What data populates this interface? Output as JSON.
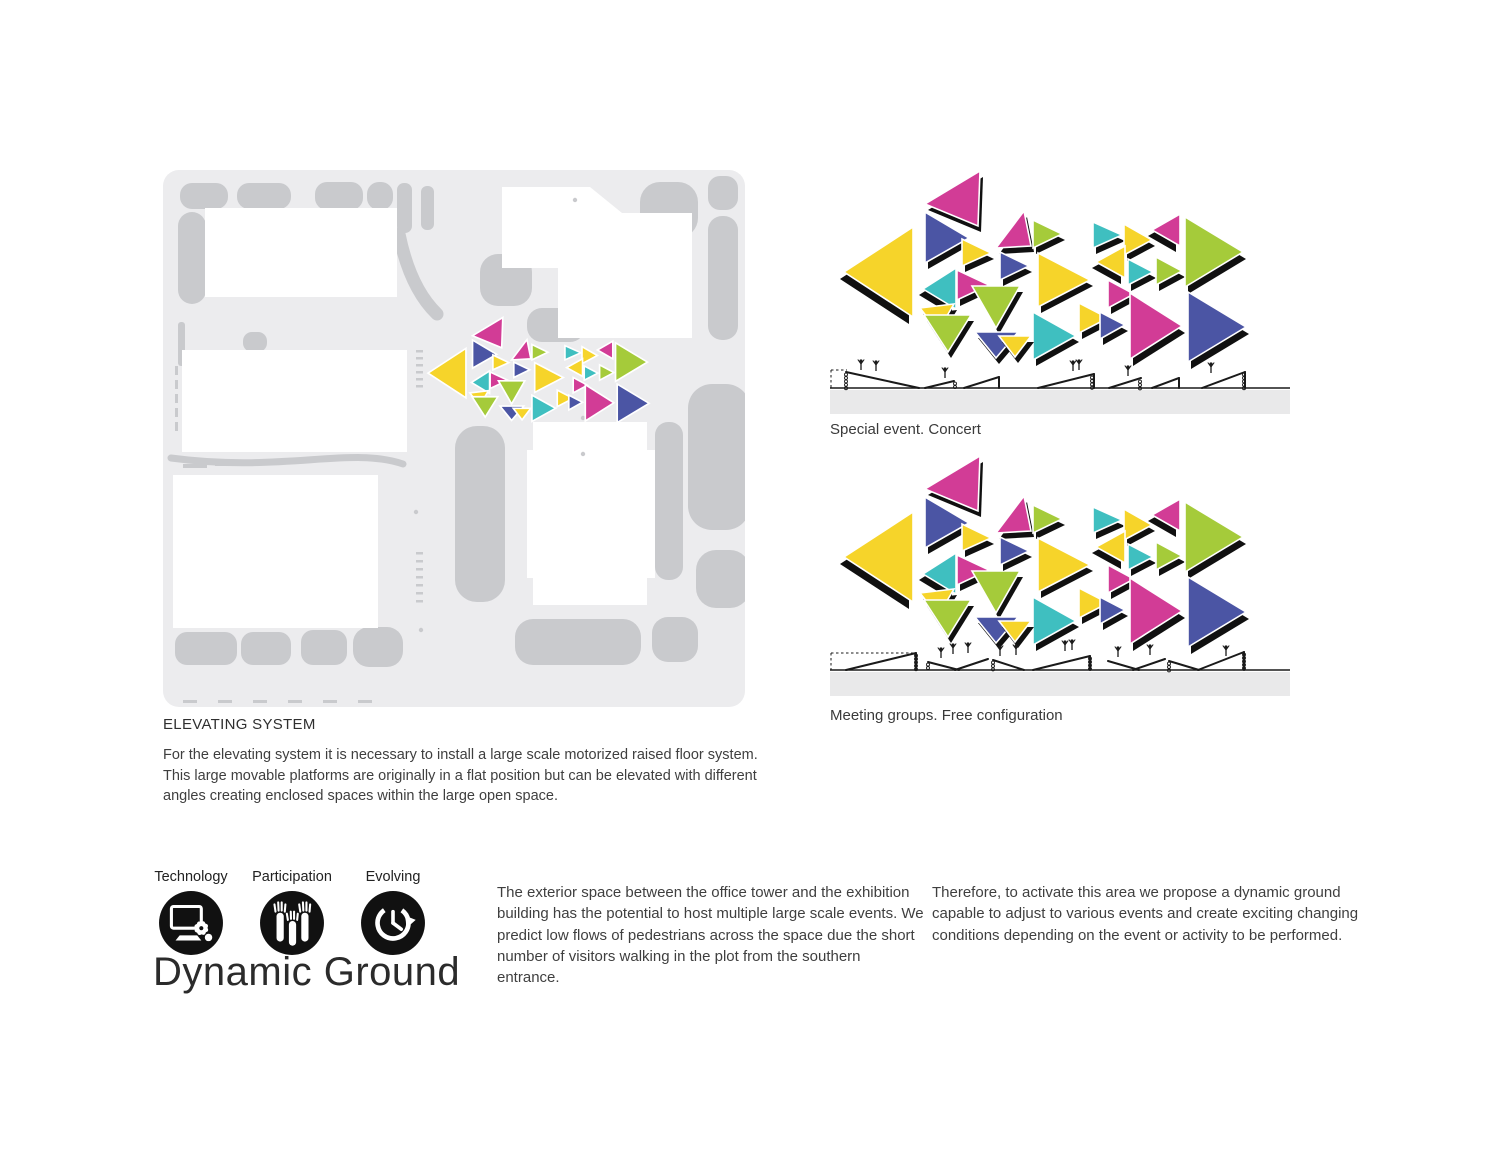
{
  "palette": {
    "magenta": "#d23c96",
    "yellow": "#f6d42a",
    "blue": "#4b55a4",
    "teal": "#3fbfc0",
    "green": "#a5cb3a",
    "shadow": "#101010",
    "band": "#e9e9ea",
    "plan_bg": "#ececee",
    "plan_blob": "#c9cacd",
    "line": "#1a1a1a"
  },
  "elevating_system": {
    "title": "ELEVATING SYSTEM",
    "body": "For the elevating system it is necessary to install a large scale motorized raised floor system. This large movable platforms are originally in a flat position but can be elevated with different angles creating enclosed spaces within the large open space."
  },
  "paragraphs": {
    "left": "The exterior space between the office tower and the exhibition building has the potential to host multiple large scale events. We predict low flows of pedestrians across the space due the short number of visitors walking in the plot from the southern entrance.",
    "right": "Therefore, to activate this area we propose a dynamic ground capable to adjust to various events and create exciting changing conditions depending on the event or activity to be performed."
  },
  "branding": {
    "title": "Dynamic Ground",
    "icons": [
      {
        "label": "Technology",
        "name": "technology-monitor-gear-icon"
      },
      {
        "label": "Participation",
        "name": "participation-raised-hands-icon"
      },
      {
        "label": "Evolving",
        "name": "evolving-clock-arrow-icon"
      }
    ]
  },
  "diagrams": {
    "triangles": [
      {
        "c": "yellow",
        "v": [
          [
            85,
            67
          ],
          [
            85,
            157
          ],
          [
            16,
            112
          ]
        ],
        "s": [
          -4,
          7
        ]
      },
      {
        "c": "magenta",
        "v": [
          [
            97,
            44
          ],
          [
            152,
            11
          ],
          [
            150,
            66
          ]
        ],
        "s": [
          3,
          6
        ]
      },
      {
        "c": "blue",
        "v": [
          [
            97,
            52
          ],
          [
            97,
            103
          ],
          [
            141,
            78
          ]
        ],
        "s": [
          3,
          6
        ]
      },
      {
        "c": "teal",
        "v": [
          [
            128,
            108
          ],
          [
            128,
            149
          ],
          [
            95,
            129
          ]
        ],
        "s": [
          -4,
          6
        ]
      },
      {
        "c": "yellow",
        "v": [
          [
            92,
            148
          ],
          [
            126,
            144
          ],
          [
            110,
            171
          ]
        ],
        "s": [
          3,
          6
        ]
      },
      {
        "c": "green",
        "v": [
          [
            96,
            155
          ],
          [
            143,
            155
          ],
          [
            120,
            192
          ]
        ],
        "s": [
          3,
          6
        ]
      },
      {
        "c": "yellow",
        "v": [
          [
            134,
            79
          ],
          [
            134,
            106
          ],
          [
            163,
            93
          ]
        ],
        "s": [
          3,
          6
        ]
      },
      {
        "c": "magenta",
        "v": [
          [
            129,
            110
          ],
          [
            129,
            140
          ],
          [
            161,
            125
          ]
        ],
        "s": [
          3,
          6
        ]
      },
      {
        "c": "green",
        "v": [
          [
            144,
            126
          ],
          [
            192,
            126
          ],
          [
            168,
            168
          ]
        ],
        "s": [
          3,
          6
        ]
      },
      {
        "c": "blue",
        "v": [
          [
            147,
            172
          ],
          [
            190,
            172
          ],
          [
            168,
            198
          ]
        ],
        "s": [
          3,
          6
        ]
      },
      {
        "c": "magenta",
        "v": [
          [
            168,
            88
          ],
          [
            203,
            86
          ],
          [
            196,
            51
          ]
        ],
        "s": [
          3,
          6
        ]
      },
      {
        "c": "blue",
        "v": [
          [
            172,
            92
          ],
          [
            172,
            120
          ],
          [
            201,
            106
          ]
        ],
        "s": [
          3,
          6
        ]
      },
      {
        "c": "green",
        "v": [
          [
            205,
            60
          ],
          [
            205,
            88
          ],
          [
            234,
            74
          ]
        ],
        "s": [
          3,
          6
        ]
      },
      {
        "c": "yellow",
        "v": [
          [
            210,
            93
          ],
          [
            210,
            147
          ],
          [
            262,
            120
          ]
        ],
        "s": [
          3,
          6
        ]
      },
      {
        "c": "teal",
        "v": [
          [
            205,
            152
          ],
          [
            205,
            200
          ],
          [
            248,
            176
          ]
        ],
        "s": [
          3,
          6
        ]
      },
      {
        "c": "yellow",
        "v": [
          [
            171,
            176
          ],
          [
            203,
            176
          ],
          [
            187,
            197
          ]
        ],
        "s": [
          3,
          6
        ]
      },
      {
        "c": "yellow",
        "v": [
          [
            251,
            143
          ],
          [
            251,
            173
          ],
          [
            280,
            158
          ]
        ],
        "s": [
          3,
          6
        ]
      },
      {
        "c": "teal",
        "v": [
          [
            265,
            62
          ],
          [
            265,
            88
          ],
          [
            294,
            75
          ]
        ],
        "s": [
          3,
          6
        ]
      },
      {
        "c": "yellow",
        "v": [
          [
            296,
            64
          ],
          [
            296,
            95
          ],
          [
            324,
            80
          ]
        ],
        "s": [
          3,
          6
        ]
      },
      {
        "c": "yellow",
        "v": [
          [
            297,
            86
          ],
          [
            297,
            118
          ],
          [
            268,
            102
          ]
        ],
        "s": [
          -4,
          6
        ]
      },
      {
        "c": "magenta",
        "v": [
          [
            280,
            120
          ],
          [
            280,
            148
          ],
          [
            306,
            134
          ]
        ],
        "s": [
          3,
          6
        ]
      },
      {
        "c": "blue",
        "v": [
          [
            272,
            152
          ],
          [
            272,
            179
          ],
          [
            297,
            165
          ]
        ],
        "s": [
          3,
          6
        ]
      },
      {
        "c": "teal",
        "v": [
          [
            300,
            99
          ],
          [
            300,
            125
          ],
          [
            325,
            112
          ]
        ],
        "s": [
          3,
          6
        ]
      },
      {
        "c": "green",
        "v": [
          [
            328,
            97
          ],
          [
            328,
            125
          ],
          [
            354,
            111
          ]
        ],
        "s": [
          3,
          6
        ]
      },
      {
        "c": "magenta",
        "v": [
          [
            352,
            54
          ],
          [
            352,
            86
          ],
          [
            324,
            70
          ]
        ],
        "s": [
          -4,
          6
        ]
      },
      {
        "c": "green",
        "v": [
          [
            357,
            57
          ],
          [
            357,
            127
          ],
          [
            415,
            92
          ]
        ],
        "s": [
          3,
          7
        ]
      },
      {
        "c": "blue",
        "v": [
          [
            360,
            132
          ],
          [
            360,
            202
          ],
          [
            418,
            167
          ]
        ],
        "s": [
          3,
          7
        ]
      },
      {
        "c": "magenta",
        "v": [
          [
            302,
            133
          ],
          [
            302,
            199
          ],
          [
            354,
            166
          ]
        ],
        "s": [
          3,
          7
        ]
      }
    ],
    "configs": [
      {
        "caption": "Special event. Concert",
        "base": 228,
        "bandY": 230,
        "lines": [
          [
            18,
            212,
            91,
            228
          ],
          [
            97,
            228,
            126,
            221
          ],
          [
            136,
            228,
            171,
            217
          ],
          [
            171,
            217,
            171,
            228
          ],
          [
            210,
            228,
            266,
            214
          ],
          [
            266,
            214,
            266,
            228
          ],
          [
            281,
            228,
            313,
            218
          ],
          [
            324,
            228,
            351,
            218
          ],
          [
            351,
            218,
            351,
            228
          ],
          [
            374,
            228,
            417,
            212
          ],
          [
            417,
            212,
            417,
            228
          ]
        ],
        "dashed": [
          [
            3,
            210,
            19,
            210
          ],
          [
            3,
            210,
            3,
            228
          ]
        ],
        "springs": [
          [
            18,
            213
          ],
          [
            127,
            222
          ],
          [
            264,
            216
          ],
          [
            312,
            220
          ],
          [
            416,
            213
          ]
        ],
        "people": [
          [
            33,
            205
          ],
          [
            48,
            206
          ],
          [
            117,
            213
          ],
          [
            245,
            206
          ],
          [
            251,
            205
          ],
          [
            300,
            211
          ],
          [
            383,
            208
          ]
        ]
      },
      {
        "caption": "Meeting groups. Free configuration",
        "base": 225,
        "bandY": 227,
        "lines": [
          [
            18,
            225,
            88,
            208
          ],
          [
            88,
            208,
            88,
            225
          ],
          [
            100,
            217,
            131,
            225
          ],
          [
            127,
            225,
            160,
            214
          ],
          [
            165,
            215,
            196,
            225
          ],
          [
            205,
            225,
            262,
            211
          ],
          [
            262,
            211,
            262,
            225
          ],
          [
            280,
            216,
            311,
            225
          ],
          [
            305,
            225,
            337,
            214
          ],
          [
            341,
            216,
            371,
            225
          ],
          [
            370,
            225,
            416,
            207
          ],
          [
            416,
            207,
            416,
            225
          ]
        ],
        "dashed": [
          [
            3,
            208,
            88,
            208
          ],
          [
            3,
            208,
            3,
            225
          ]
        ],
        "springs": [
          [
            88,
            209
          ],
          [
            100,
            218
          ],
          [
            165,
            216
          ],
          [
            262,
            212
          ],
          [
            341,
            217
          ],
          [
            416,
            208
          ]
        ],
        "people": [
          [
            113,
            208
          ],
          [
            125,
            204
          ],
          [
            140,
            203
          ],
          [
            172,
            206
          ],
          [
            188,
            205
          ],
          [
            237,
            201
          ],
          [
            244,
            200
          ],
          [
            290,
            207
          ],
          [
            322,
            205
          ],
          [
            398,
            206
          ]
        ]
      }
    ]
  },
  "site_plan": {
    "blob_rects": [
      [
        17,
        13,
        48,
        26,
        12
      ],
      [
        74,
        13,
        54,
        26,
        12
      ],
      [
        152,
        12,
        48,
        28,
        12
      ],
      [
        204,
        12,
        26,
        28,
        12
      ],
      [
        234,
        13,
        15,
        50,
        7
      ],
      [
        258,
        16,
        13,
        44,
        6
      ],
      [
        15,
        42,
        28,
        92,
        14
      ],
      [
        15,
        152,
        7,
        44,
        3
      ],
      [
        22,
        208,
        8,
        34,
        4
      ],
      [
        80,
        162,
        24,
        20,
        9
      ],
      [
        477,
        12,
        58,
        56,
        20
      ],
      [
        545,
        6,
        30,
        34,
        12
      ],
      [
        545,
        46,
        30,
        124,
        14
      ],
      [
        317,
        84,
        52,
        52,
        18
      ],
      [
        364,
        138,
        58,
        34,
        15
      ],
      [
        292,
        256,
        50,
        176,
        22
      ],
      [
        492,
        252,
        28,
        158,
        13
      ],
      [
        525,
        214,
        62,
        146,
        24
      ],
      [
        533,
        380,
        54,
        58,
        20
      ],
      [
        352,
        449,
        126,
        46,
        18
      ],
      [
        489,
        447,
        46,
        45,
        16
      ],
      [
        12,
        462,
        62,
        33,
        12
      ],
      [
        78,
        462,
        50,
        33,
        12
      ],
      [
        138,
        460,
        46,
        35,
        12
      ],
      [
        190,
        457,
        50,
        40,
        16
      ]
    ],
    "blob_paths": [
      {
        "d": "M236,64 Q247,118 274,144",
        "w": 13
      },
      {
        "d": "M8,288 C120,303 188,276 240,294",
        "w": 7
      }
    ],
    "white_rects": [
      [
        42,
        38,
        192,
        89
      ],
      [
        19,
        180,
        225,
        102
      ],
      [
        10,
        305,
        205,
        153
      ]
    ],
    "white_polys": [
      [
        [
          339,
          17
        ],
        [
          427,
          17
        ],
        [
          459,
          43
        ],
        [
          529,
          43
        ],
        [
          529,
          168
        ],
        [
          395,
          168
        ],
        [
          395,
          98
        ],
        [
          339,
          98
        ]
      ],
      [
        [
          370,
          252
        ],
        [
          484,
          252
        ],
        [
          484,
          280
        ],
        [
          492,
          280
        ],
        [
          492,
          408
        ],
        [
          484,
          408
        ],
        [
          484,
          435
        ],
        [
          370,
          435
        ],
        [
          370,
          408
        ],
        [
          364,
          408
        ],
        [
          364,
          280
        ],
        [
          370,
          280
        ]
      ]
    ],
    "dashes": [
      [
        253,
        180,
        7,
        2.5
      ],
      [
        253,
        187,
        7,
        2.5
      ],
      [
        253,
        194,
        7,
        2.5
      ],
      [
        253,
        201,
        7,
        2.5
      ],
      [
        253,
        208,
        7,
        2.5
      ],
      [
        253,
        215,
        7,
        2.5
      ],
      [
        253,
        382,
        7,
        2.5
      ],
      [
        253,
        390,
        7,
        2.5
      ],
      [
        253,
        398,
        7,
        2.5
      ],
      [
        253,
        406,
        7,
        2.5
      ],
      [
        253,
        414,
        7,
        2.5
      ],
      [
        253,
        422,
        7,
        2.5
      ],
      [
        253,
        430,
        7,
        2.5
      ],
      [
        12,
        196,
        3,
        9
      ],
      [
        12,
        210,
        3,
        9
      ],
      [
        12,
        224,
        3,
        9
      ],
      [
        12,
        238,
        3,
        9
      ],
      [
        12,
        252,
        3,
        9
      ],
      [
        20,
        530,
        14,
        3
      ],
      [
        55,
        530,
        14,
        3
      ],
      [
        90,
        530,
        14,
        3
      ],
      [
        125,
        530,
        14,
        3
      ],
      [
        160,
        530,
        14,
        3
      ],
      [
        195,
        530,
        14,
        3
      ],
      [
        20,
        294,
        24,
        4
      ],
      [
        52,
        292,
        26,
        4
      ]
    ],
    "dots": [
      [
        412,
        30
      ],
      [
        253,
        342
      ],
      [
        420,
        248
      ],
      [
        420,
        284
      ],
      [
        500,
        330
      ],
      [
        258,
        460
      ]
    ]
  }
}
